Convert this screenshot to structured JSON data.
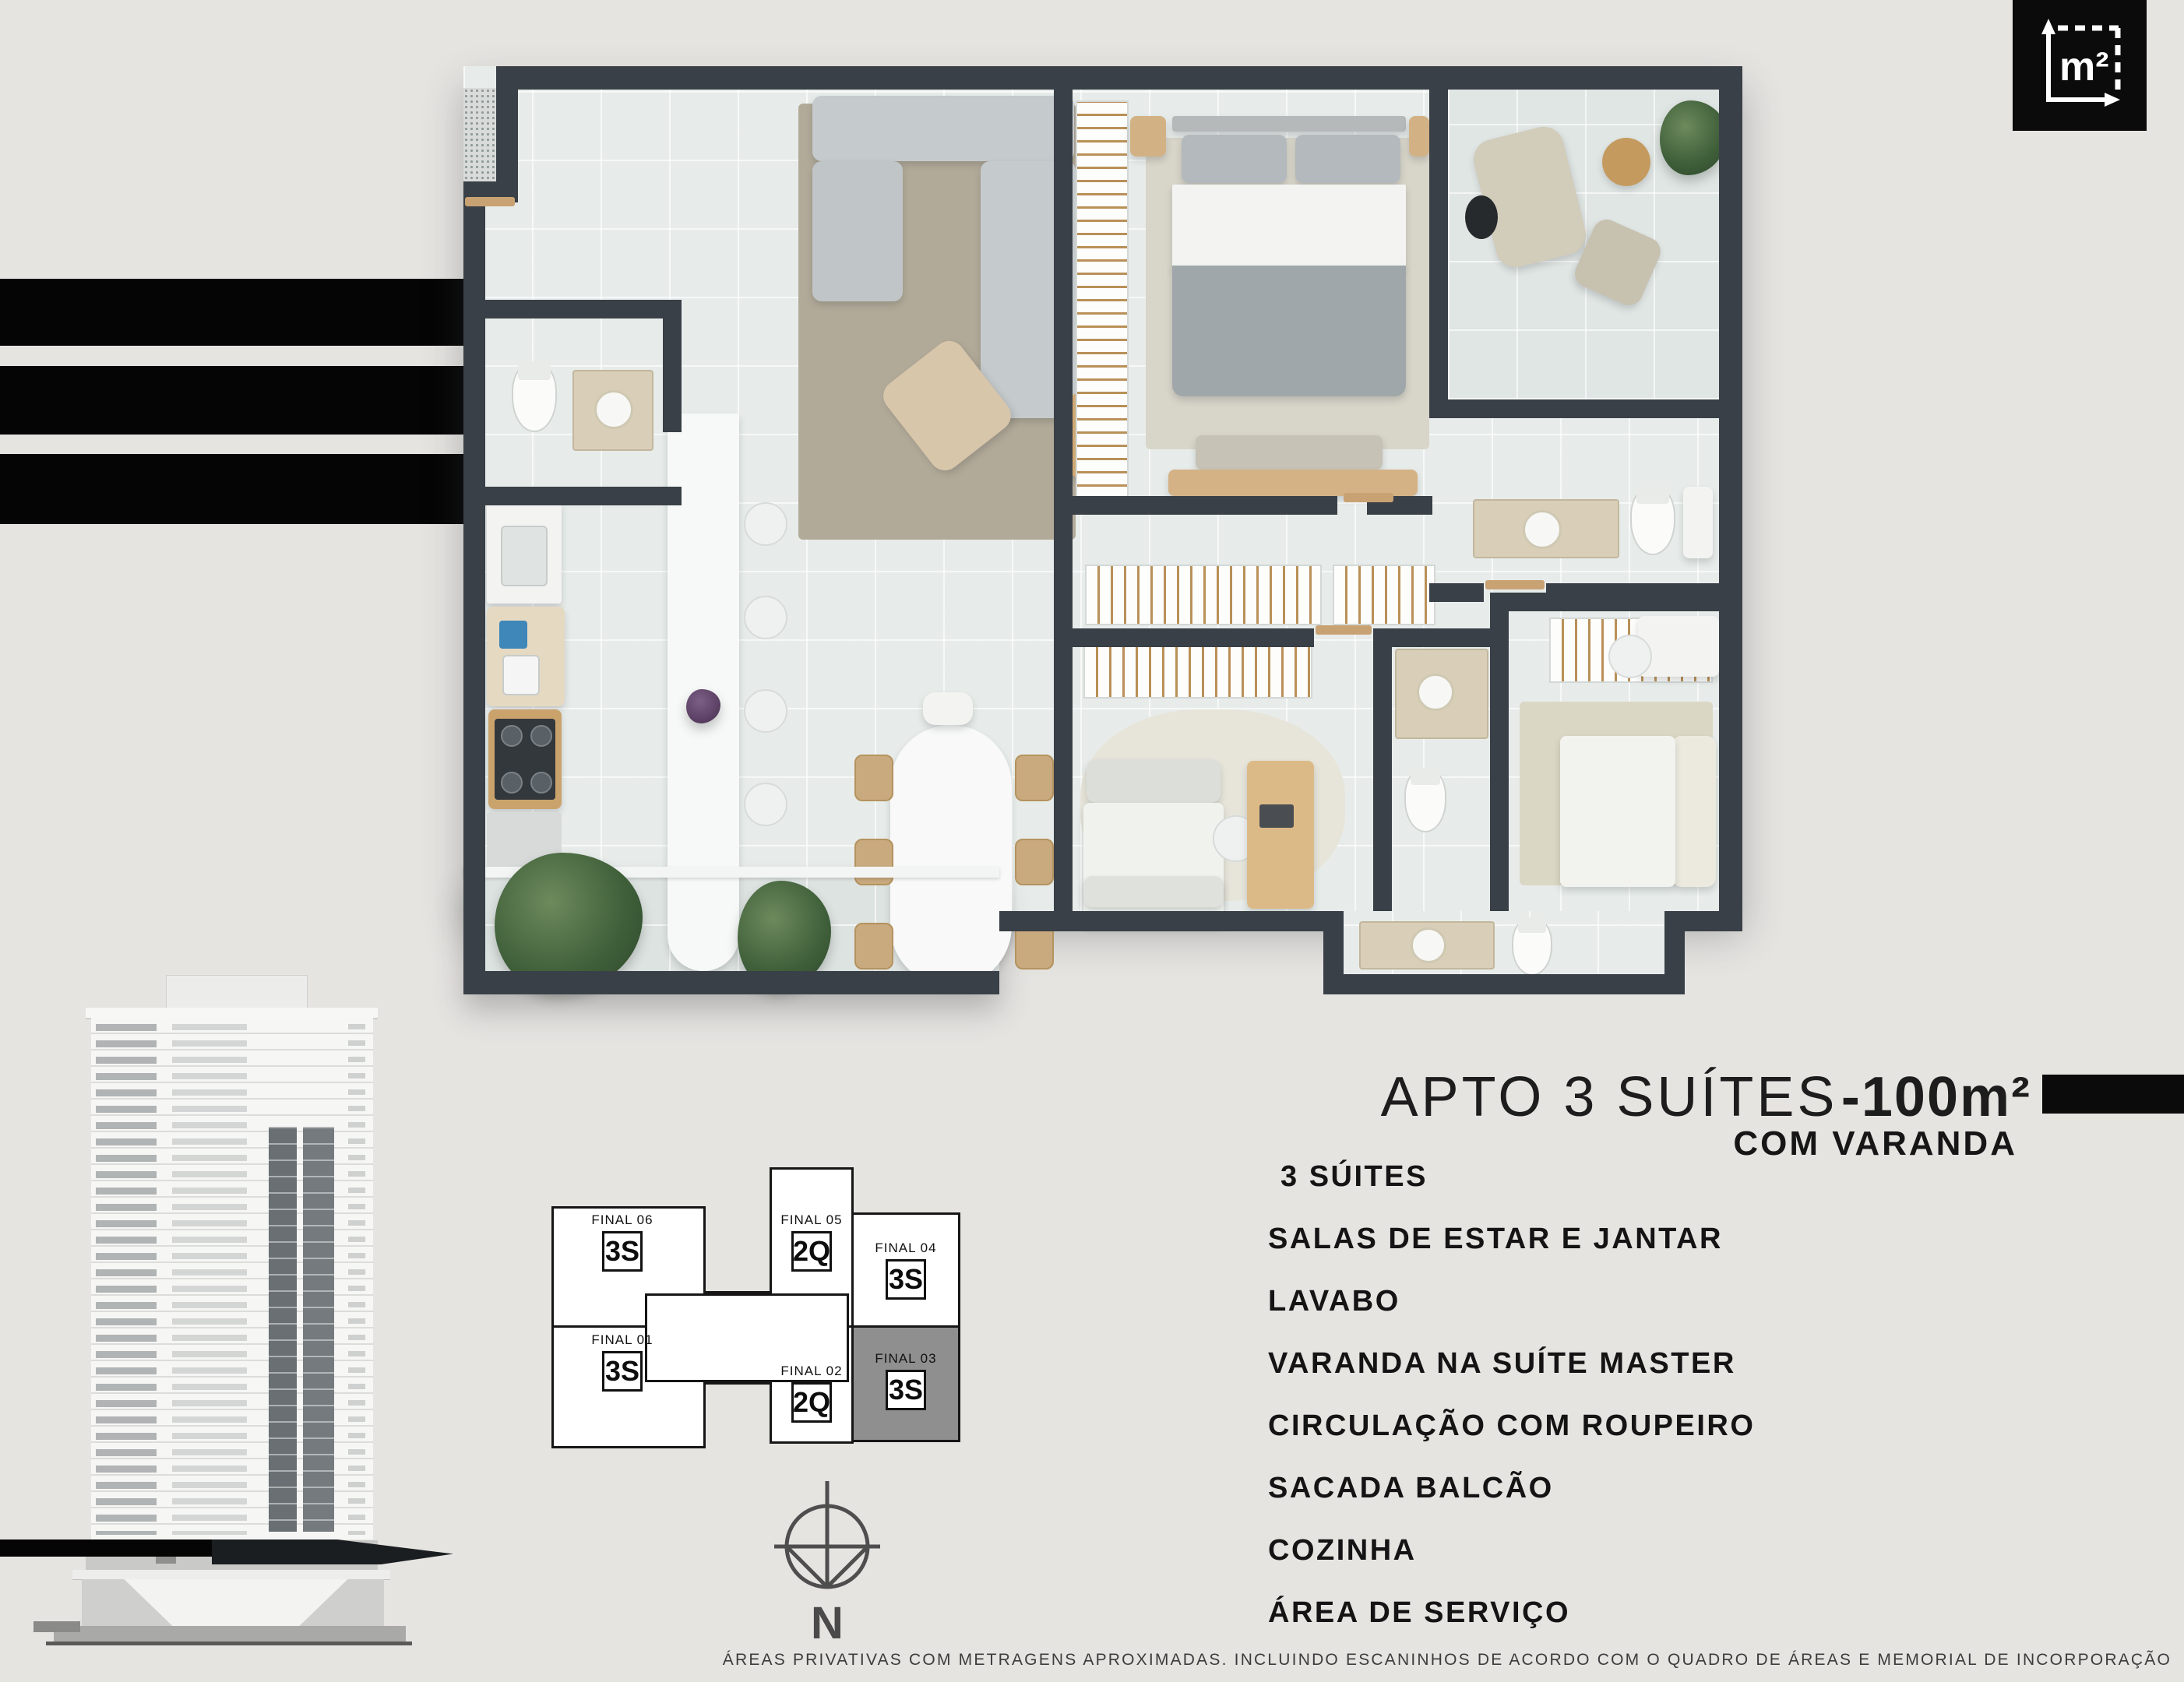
{
  "page": {
    "background_color": "#e6e4e1",
    "accent_black": "#0b0b0b",
    "footer_disclaimer": "ÁREAS PRIVATIVAS COM METRAGENS APROXIMADAS. INCLUINDO ESCANINHOS DE ACORDO COM O QUADRO DE ÁREAS E MEMORIAL DE INCORPORAÇÃO"
  },
  "badge": {
    "area_unit_label": "m²"
  },
  "title": {
    "main": "APTO 3 SUÍTES",
    "area": "-100m²",
    "subtitle": "COM VARANDA"
  },
  "features": [
    "3 SÚITES",
    "SALAS DE ESTAR E JANTAR",
    "LAVABO",
    "VARANDA NA SUÍTE MASTER",
    "CIRCULAÇÃO COM ROUPEIRO",
    "SACADA BALCÃO",
    "COZINHA",
    "ÁREA DE SERVIÇO"
  ],
  "key_plan": {
    "highlight_color": "#8f8f8f",
    "units": [
      {
        "label": "FINAL 06",
        "type": "3S",
        "highlighted": false
      },
      {
        "label": "FINAL 05",
        "type": "2Q",
        "highlighted": false
      },
      {
        "label": "FINAL 04",
        "type": "3S",
        "highlighted": false
      },
      {
        "label": "FINAL 03",
        "type": "3S",
        "highlighted": true
      },
      {
        "label": "FINAL 02",
        "type": "2Q",
        "highlighted": false
      },
      {
        "label": "FINAL 01",
        "type": "3S",
        "highlighted": false
      }
    ]
  },
  "compass": {
    "north_label": "N"
  },
  "floor_plan": {
    "wall_color": "#3a4047",
    "rooms": [
      "living",
      "dining",
      "kitchen",
      "lavabo",
      "master-suite",
      "varanda",
      "master-bath",
      "circulation",
      "suite-2",
      "bath-2",
      "suite-3",
      "bath-3",
      "sacada-balcao",
      "area-servico"
    ]
  }
}
